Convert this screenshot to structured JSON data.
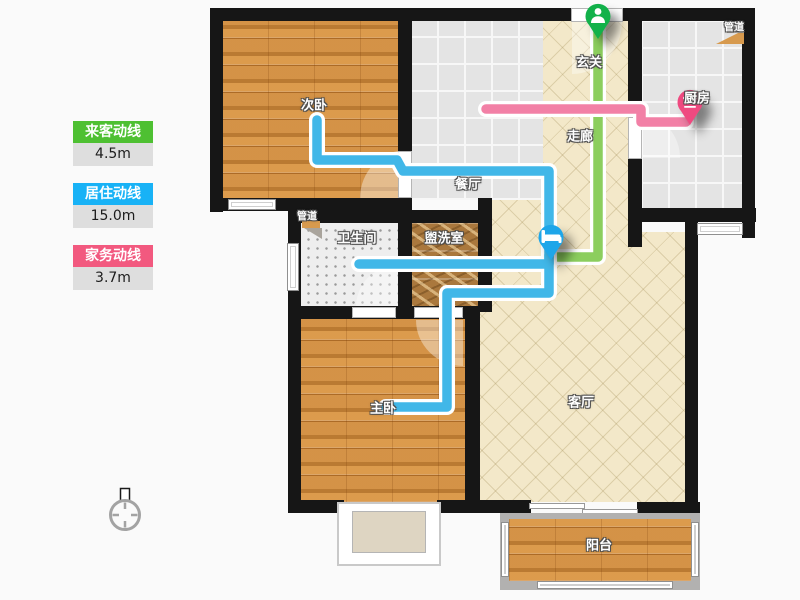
{
  "legend": {
    "guest": {
      "label": "来客动线",
      "value": "4.5m"
    },
    "living": {
      "label": "居住动线",
      "value": "15.0m"
    },
    "housework": {
      "label": "家务动线",
      "value": "3.7m"
    }
  },
  "rooms": {
    "secondary_bedroom": {
      "label": "次卧"
    },
    "dining": {
      "label": "餐厅"
    },
    "entry": {
      "label": "玄关"
    },
    "corridor": {
      "label": "走廊"
    },
    "kitchen": {
      "label": "厨房"
    },
    "kitchen_duct": {
      "label": "管道"
    },
    "bath_duct": {
      "label": "管道"
    },
    "bathroom": {
      "label": "卫生间"
    },
    "washroom": {
      "label": "盥洗室"
    },
    "master_bedroom": {
      "label": "主卧"
    },
    "living_room": {
      "label": "客厅"
    },
    "balcony": {
      "label": "阳台"
    }
  },
  "icons": {
    "guest_pin": "person-icon",
    "living_pin": "bed-icon",
    "housework_pin": "stove-icon",
    "compass": "compass-icon"
  },
  "colors": {
    "legend_guest": "#4ec032",
    "legend_living": "#18b2f6",
    "legend_housework": "#f2597f",
    "guest_line": "#8cce5e",
    "living_line": "#41b7e8",
    "housework_line": "#f280a6",
    "guest_pin": "#12b14a",
    "living_pin": "#1ea6e9",
    "housework_pin": "#ef4a80"
  }
}
